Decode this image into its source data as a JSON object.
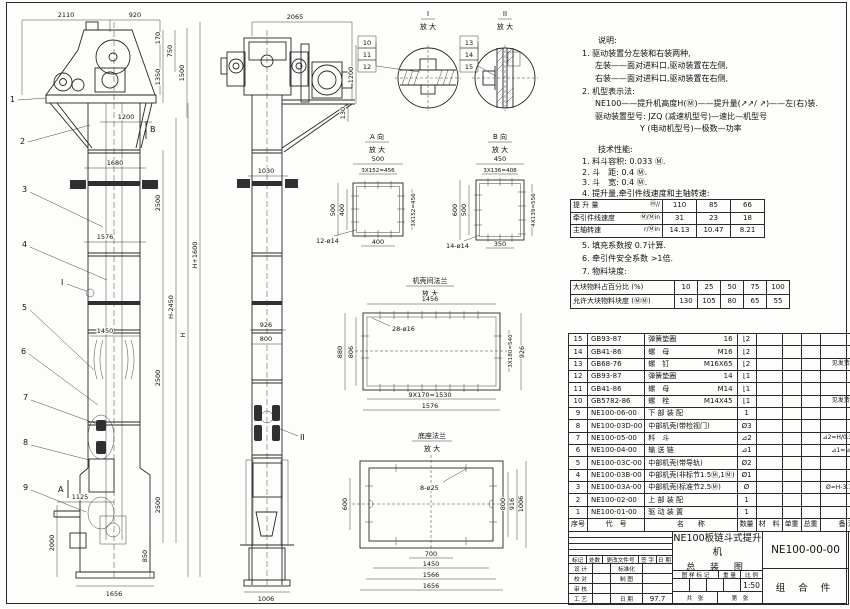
{
  "sheet": {
    "bg": "#fdfdfb",
    "line_color": "#262626"
  },
  "front": {
    "balloons": [
      "1",
      "2",
      "3",
      "4",
      "5",
      "6",
      "7",
      "8",
      "9"
    ],
    "markers": {
      "a": "A",
      "b": "B",
      "i": "I"
    },
    "dims": {
      "t2110": "2110",
      "t920": "920",
      "v170": "170",
      "v750": "750",
      "v1350": "1350",
      "v1500": "1500",
      "h1200": "1200",
      "h1680": "1680",
      "s2500a": "2500",
      "s2500b": "2500",
      "s2500c": "2500",
      "h1576": "1576",
      "h1450": "1450",
      "hm2450": "H-2450",
      "h": "H",
      "hp1600": "H+1600",
      "h1125": "1125",
      "v2000": "2000",
      "v850": "850",
      "h1656": "1656"
    }
  },
  "side": {
    "marker": "II",
    "dims": {
      "t2065": "2065",
      "v1200": "1200",
      "v130": "130",
      "h1030": "1030",
      "h926": "926",
      "h800": "800",
      "h1006": "1006"
    }
  },
  "di": {
    "t": "I",
    "sub": "放 大",
    "b": [
      "10",
      "11",
      "12"
    ]
  },
  "dii": {
    "t": "II",
    "sub": "放 大",
    "b": [
      "13",
      "14",
      "15"
    ]
  },
  "da": {
    "t": "A 向",
    "sub": "放 大",
    "d500t": "500",
    "pitch_t": "3X152=456",
    "d500l": "500",
    "d400l": "400",
    "pitch_r": "3X152=456",
    "d400b": "400",
    "holes": "12-ø14"
  },
  "db": {
    "t": "B 向",
    "sub": "放 大",
    "d450": "450",
    "pitch_t": "3X136=408",
    "d600": "600",
    "d500": "500",
    "pitch_r": "4X139=556",
    "d350": "350",
    "holes": "14-ø14"
  },
  "df": {
    "t": "机壳间法兰",
    "sub": "放 大",
    "d1456": "1456",
    "holes": "28-ø16",
    "d880": "880",
    "d806": "806",
    "pitch_r": "3X180=540",
    "d926": "926",
    "pitch_b": "9X170=1530",
    "d1576": "1576"
  },
  "dbase": {
    "t": "底座法兰",
    "sub": "放 大",
    "holes": "8-ø25",
    "d600": "600",
    "d800": "800",
    "d916": "916",
    "d1006": "1006",
    "d700": "700",
    "d1450": "1450",
    "d1566": "1566",
    "d1656": "1656"
  },
  "notes": {
    "heading": "说明:",
    "lines": [
      "1. 驱动装置分左装和右装两种,",
      "左装——面对进料口,驱动装置在左侧,",
      "右装——面对进料口,驱动装置在右侧,",
      "2. 机型表示法:",
      "NE100——提升机高度H(Ⓜ)——提升量(↗↗/ ↗)——左(右)装.",
      "驱动装置型号: JZQ (减速机型号)—速比—机型号",
      "Y (电动机型号)—极数—功率"
    ]
  },
  "tech": {
    "heading": "技术性能:",
    "items": [
      "1. 料斗容积: 0.033 Ⓜ.",
      "2. 斗　距: 0.4 Ⓜ.",
      "3. 斗　宽: 0.4 Ⓜ.",
      "4. 提升量,牵引件线速度和主轴转速:"
    ],
    "more": [
      "5. 填充系数按 0.7计算.",
      "6. 牵引件安全系数 >1倍.",
      "7. 物料块度:"
    ]
  },
  "perf": {
    "rows": [
      {
        "label": "提 升 量",
        "unit": "Ⓜ/∕",
        "v1": "110",
        "v2": "85",
        "v3": "66"
      },
      {
        "label": "牵引件线速度",
        "unit": "Ⓜ/Ⓜin",
        "v1": "31",
        "v2": "23",
        "v3": "18"
      },
      {
        "label": "主轴转速",
        "unit": "r/Ⓜin",
        "v1": "14.13",
        "v2": "10.47",
        "v3": "8.21"
      }
    ]
  },
  "lump": {
    "rows": [
      {
        "label": "大块物料占百分比 (%)",
        "v": [
          "10",
          "25",
          "50",
          "75",
          "100"
        ]
      },
      {
        "label": "允许大块物料块度 (ⓂⓂ)",
        "v": [
          "130",
          "105",
          "80",
          "65",
          "55"
        ]
      }
    ]
  },
  "bom": {
    "head": {
      "no": "序号",
      "code": "代　号",
      "name": "名　　称",
      "qty": "数量",
      "material": "材　料",
      "unit_w": "单重",
      "total_w": "总重",
      "remark": "备 注"
    },
    "rows": [
      {
        "no": "15",
        "code": "GB93-87",
        "name": "弹簧垫圈",
        "spec": "16",
        "qty": "⌊2",
        "material": "",
        "uw": "",
        "tw": "",
        "remark": ""
      },
      {
        "no": "14",
        "code": "GB41-86",
        "name": "螺　母",
        "spec": "M16",
        "qty": "⌊2",
        "material": "",
        "uw": "",
        "tw": "",
        "remark": ""
      },
      {
        "no": "13",
        "code": "GB68-76",
        "name": "螺　钉",
        "spec": "M16X65",
        "qty": "⌊2",
        "material": "",
        "uw": "",
        "tw": "",
        "remark": "见发货清单"
      },
      {
        "no": "12",
        "code": "GB93-87",
        "name": "弹簧垫圈",
        "spec": "14",
        "qty": "⌊1",
        "material": "",
        "uw": "",
        "tw": "",
        "remark": ""
      },
      {
        "no": "11",
        "code": "GB41-86",
        "name": "螺　母",
        "spec": "M14",
        "qty": "⌊1",
        "material": "",
        "uw": "",
        "tw": "",
        "remark": ""
      },
      {
        "no": "10",
        "code": "GB5782-86",
        "name": "螺　栓",
        "spec": "M14X45",
        "qty": "⌊1",
        "material": "",
        "uw": "",
        "tw": "",
        "remark": "见发货清单"
      },
      {
        "no": "9",
        "code": "NE100-06-00",
        "name": "下 部 装 配",
        "spec": "",
        "qty": "1",
        "material": "",
        "uw": "",
        "tw": "",
        "remark": ""
      },
      {
        "no": "8",
        "code": "NE100-03D-00",
        "name": "中部机壳(带检视门)",
        "spec": "",
        "qty": "Ø3",
        "material": "",
        "uw": "",
        "tw": "",
        "remark": ""
      },
      {
        "no": "7",
        "code": "NE100-05-00",
        "name": "料　斗",
        "spec": "",
        "qty": "⊿2",
        "material": "",
        "uw": "",
        "tw": "",
        "remark": "⊿2=H/0.2+5.75"
      },
      {
        "no": "6",
        "code": "NE100-04-00",
        "name": "输 送 链",
        "spec": "",
        "qty": "⊿1",
        "material": "",
        "uw": "",
        "tw": "",
        "remark": "⊿1=⊿2X4"
      },
      {
        "no": "5",
        "code": "NE100-03C-00",
        "name": "中部机壳(带导轨)",
        "spec": "",
        "qty": "Ø2",
        "material": "",
        "uw": "",
        "tw": "",
        "remark": ""
      },
      {
        "no": "4",
        "code": "NE100-03B-00",
        "name": "中部机壳(非标节1.5Ⓜ,1Ⓜ)",
        "spec": "",
        "qty": "Ø1",
        "material": "",
        "uw": "",
        "tw": "",
        "remark": ""
      },
      {
        "no": "3",
        "code": "NE100-03A-00",
        "name": "中部机壳(标准节2.5Ⓜ)",
        "spec": "",
        "qty": "Ø",
        "material": "",
        "uw": "",
        "tw": "",
        "remark": "Ø=H-3.15/2.5"
      },
      {
        "no": "2",
        "code": "NE100-02-00",
        "name": "上 部 装 配",
        "spec": "",
        "qty": "1",
        "material": "",
        "uw": "",
        "tw": "",
        "remark": ""
      },
      {
        "no": "1",
        "code": "NE100-01-00",
        "name": "驱 动 装 置",
        "spec": "",
        "qty": "1",
        "material": "",
        "uw": "",
        "tw": "",
        "remark": ""
      }
    ]
  },
  "tb": {
    "title1": "NE100板链斗式提升机",
    "title2": "总 装 图",
    "dwg_no": "NE100-00-00",
    "part": "组 合 件",
    "scale": "1:50",
    "date": "97.7",
    "rev": [
      "标记",
      "处数",
      "更改文件号",
      "签 字",
      "日 期"
    ],
    "roles": [
      {
        "l": "设 计",
        "r": "标准化",
        "v": ""
      },
      {
        "l": "校 对",
        "r": "制 图",
        "v": ""
      },
      {
        "l": "审 核",
        "r": "",
        "v": ""
      },
      {
        "l": "工 艺",
        "r": "日 期",
        "v": "97.7"
      }
    ],
    "stamp": [
      "图 样 标 记",
      "重 量",
      "比 例"
    ],
    "sheets": [
      "共　张",
      "第　张"
    ]
  }
}
